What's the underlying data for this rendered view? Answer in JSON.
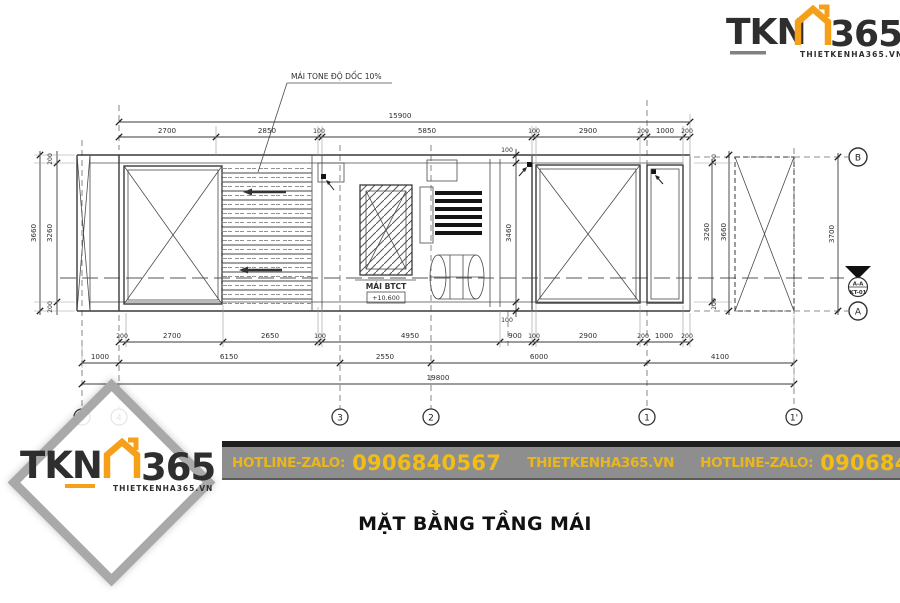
{
  "logo": {
    "brand": "TKN",
    "suffix": "365",
    "domain": "THIETKENHA365.VN"
  },
  "watermark": {
    "brand": "TKN",
    "suffix": "365",
    "domain": "THIETKENHA365.VN"
  },
  "banner": {
    "hotline_label": "HOTLINE-ZALO:",
    "phone": "0906840567",
    "website": "THIETKENHA365.VN",
    "hotline_label_2": "HOTLINE-ZALO:",
    "phone_2": "0906840567"
  },
  "title": "MẶT BẰNG TẦNG MÁI",
  "drawing": {
    "note": "MÁI TONE ĐỘ DỐC 10%",
    "slab_label": "MÁI BTCT",
    "slab_level": "+10.600",
    "dims": {
      "top_overall": "15900",
      "top_row": [
        "2700",
        "2850",
        "100",
        "5850",
        "100",
        "2900",
        "200",
        "1000",
        "200"
      ],
      "bottom_row_1": [
        "200",
        "2700",
        "2650",
        "100",
        "4950",
        "900",
        "100",
        "2900",
        "200",
        "1000",
        "200"
      ],
      "bottom_row_2": [
        "1000",
        "6150",
        "2550",
        "6000",
        "4100"
      ],
      "overall": "19800",
      "left_outer": "3660",
      "left_inner": "3260",
      "left_top": "200",
      "left_bottom": "200",
      "center_top": "100",
      "center_height": "3460",
      "center_bottom": "100",
      "right_inner": "3260",
      "right_outer": "3660",
      "right_top": "200",
      "right_bottom": "200",
      "far_right": "3700"
    },
    "axes": {
      "bottom": [
        "5",
        "4",
        "3",
        "2",
        "1",
        "1'"
      ],
      "right": [
        "B",
        "A"
      ]
    },
    "section_marker": {
      "line1": "A-A",
      "line2": "KT-01"
    }
  },
  "colors": {
    "accent_orange": "#f6a01a",
    "logo_dark": "#57585b",
    "banner_gray": "#8e8e8e",
    "banner_gold": "#eab61e"
  }
}
